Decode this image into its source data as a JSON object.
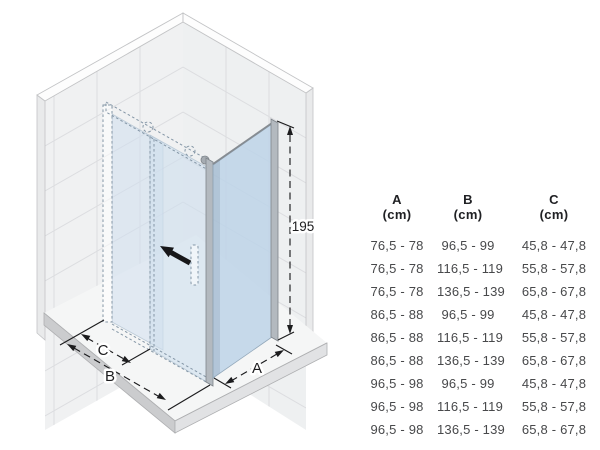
{
  "diagram": {
    "description": "Isometric drawing of a corner shower enclosure with sliding door and fixed side panel on a shower tray",
    "labels": {
      "height": "195",
      "dim_a": "A",
      "dim_b": "B",
      "dim_c": "C"
    }
  },
  "table": {
    "columns": [
      {
        "letter": "A",
        "unit": "(cm)"
      },
      {
        "letter": "B",
        "unit": "(cm)"
      },
      {
        "letter": "C",
        "unit": "(cm)"
      }
    ],
    "rows": [
      [
        "76,5 - 78",
        "96,5 - 99",
        "45,8 - 47,8"
      ],
      [
        "76,5 - 78",
        "116,5 - 119",
        "55,8 - 57,8"
      ],
      [
        "76,5 - 78",
        "136,5 - 139",
        "65,8 - 67,8"
      ],
      [
        "86,5 - 88",
        "96,5 - 99",
        "45,8 - 47,8"
      ],
      [
        "86,5 - 88",
        "116,5 - 119",
        "55,8 - 57,8"
      ],
      [
        "86,5 - 88",
        "136,5 - 139",
        "65,8 - 67,8"
      ],
      [
        "96,5 - 98",
        "96,5 - 99",
        "45,8 - 47,8"
      ],
      [
        "96,5 - 98",
        "116,5 - 119",
        "55,8 - 57,8"
      ],
      [
        "96,5 - 98",
        "136,5 - 139",
        "65,8 - 67,8"
      ]
    ]
  },
  "colors": {
    "wall": "#f0f1f2",
    "grout": "#dcdde0",
    "cap": "#fdfdfd",
    "edge": "#c2c3c5",
    "outer": "#e9eaeb",
    "tray-top": "#f5f6f6",
    "tray-left": "#cbccce",
    "tray-right": "#e1e2e4",
    "tray-line": "#aeafb1",
    "glass-door": "#cfdfee",
    "glass-side": "#bdd4e7",
    "profile": "#b3b9bf",
    "profile-edge": "#7e848a",
    "hidden": "#8496a6",
    "ink": "#1c1c1e",
    "table-ink": "#48494b",
    "table-head": "#202124"
  }
}
